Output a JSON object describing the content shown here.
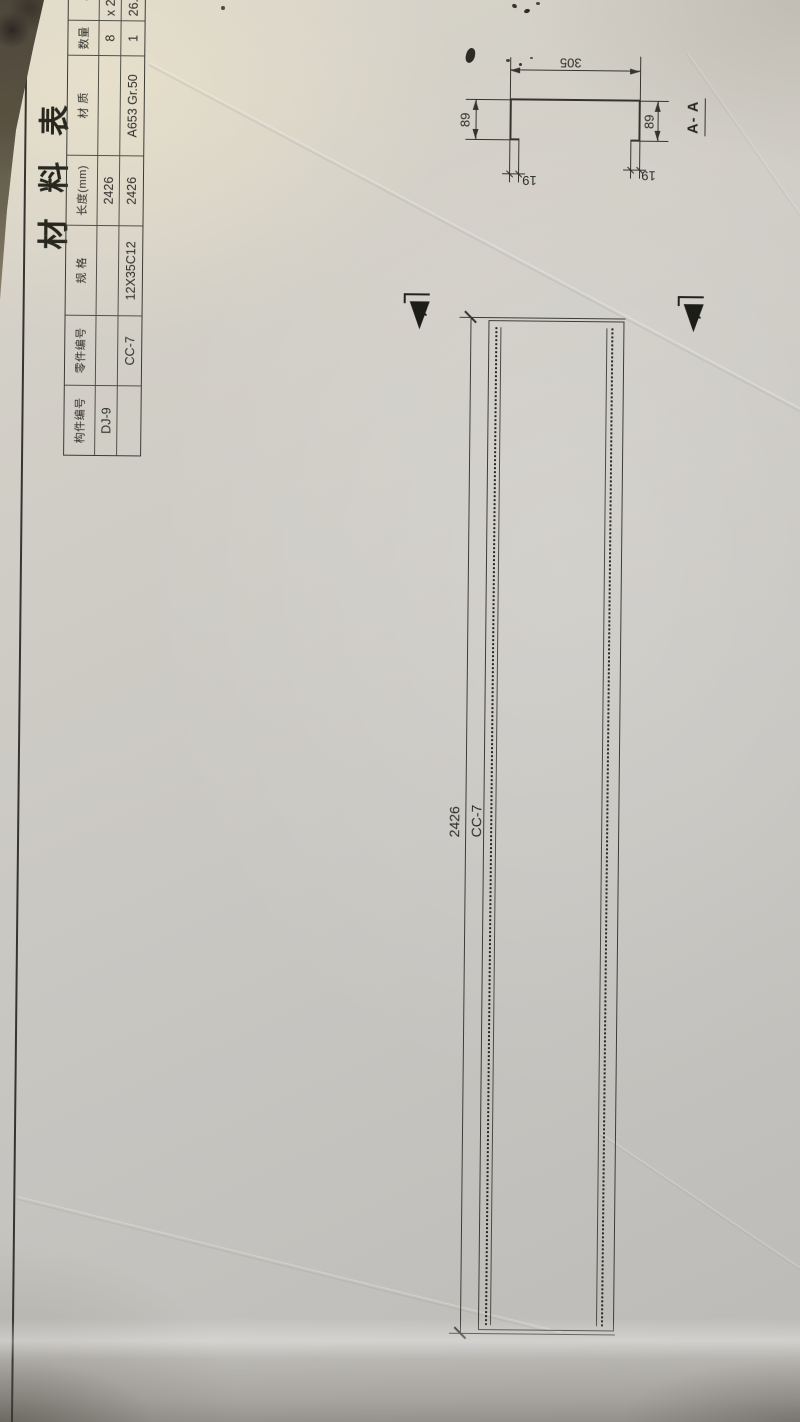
{
  "sheet": {
    "title": "材 料 表",
    "table": {
      "headers": [
        "构件编号",
        "零件编号",
        "规 格",
        "长度(mm)",
        "材 质",
        "数量",
        "单 重"
      ],
      "rows": [
        [
          "DJ-9",
          "",
          "",
          "2426",
          "",
          "8",
          "x 26.69"
        ],
        [
          "",
          "CC-7",
          "12X35C12",
          "2426",
          "A653 Gr.50",
          "1",
          "26.6"
        ]
      ]
    },
    "member": {
      "part_label": "CC-7",
      "length_dim": "2426"
    },
    "section": {
      "cut_label": "A",
      "view_label": "A- A",
      "dims": {
        "web_width": "305",
        "flange_top": "89",
        "flange_bottom": "89",
        "lip_top": "19",
        "lip_bottom": "19"
      }
    }
  }
}
